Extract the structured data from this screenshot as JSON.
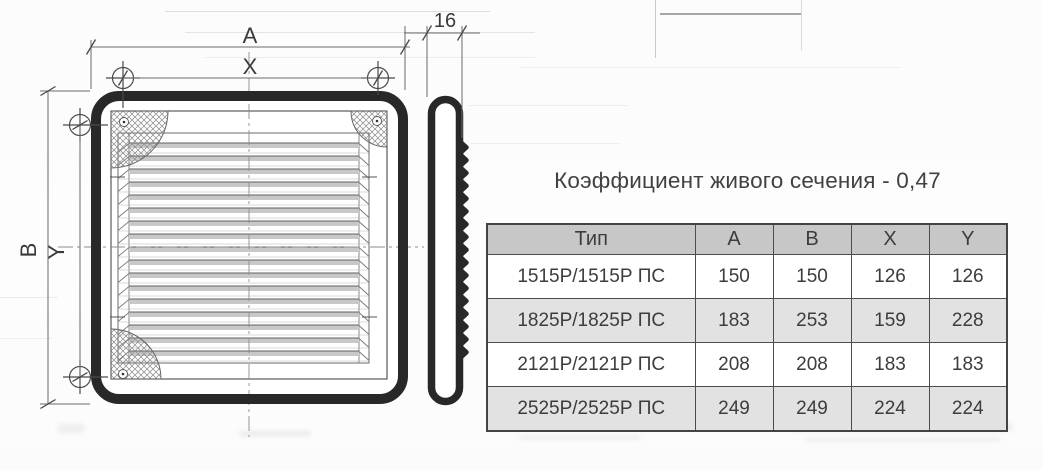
{
  "title": "Коэффициент живого сечения - 0,47",
  "diagram": {
    "labels": {
      "width_outer": "A",
      "width_holes": "X",
      "height_outer": "B",
      "height_holes": "Y",
      "thickness": "16"
    }
  },
  "table": {
    "headers": [
      "Тип",
      "A",
      "B",
      "X",
      "Y"
    ],
    "rows": [
      [
        "1515Р/1515Р ПС",
        "150",
        "150",
        "126",
        "126"
      ],
      [
        "1825Р/1825Р ПС",
        "183",
        "253",
        "159",
        "228"
      ],
      [
        "2121Р/2121Р ПС",
        "208",
        "208",
        "183",
        "183"
      ],
      [
        "2525Р/2525Р ПС",
        "249",
        "249",
        "224",
        "224"
      ]
    ]
  },
  "colors": {
    "frame_line": "#282828",
    "thin_line": "#5a5a5a",
    "dim_line": "#6a6a6a",
    "table_header_bg": "#c7c7c7",
    "table_alt_row_bg": "#e2e2e2",
    "table_border": "#4c4c4c",
    "text": "#3c3c3c"
  }
}
